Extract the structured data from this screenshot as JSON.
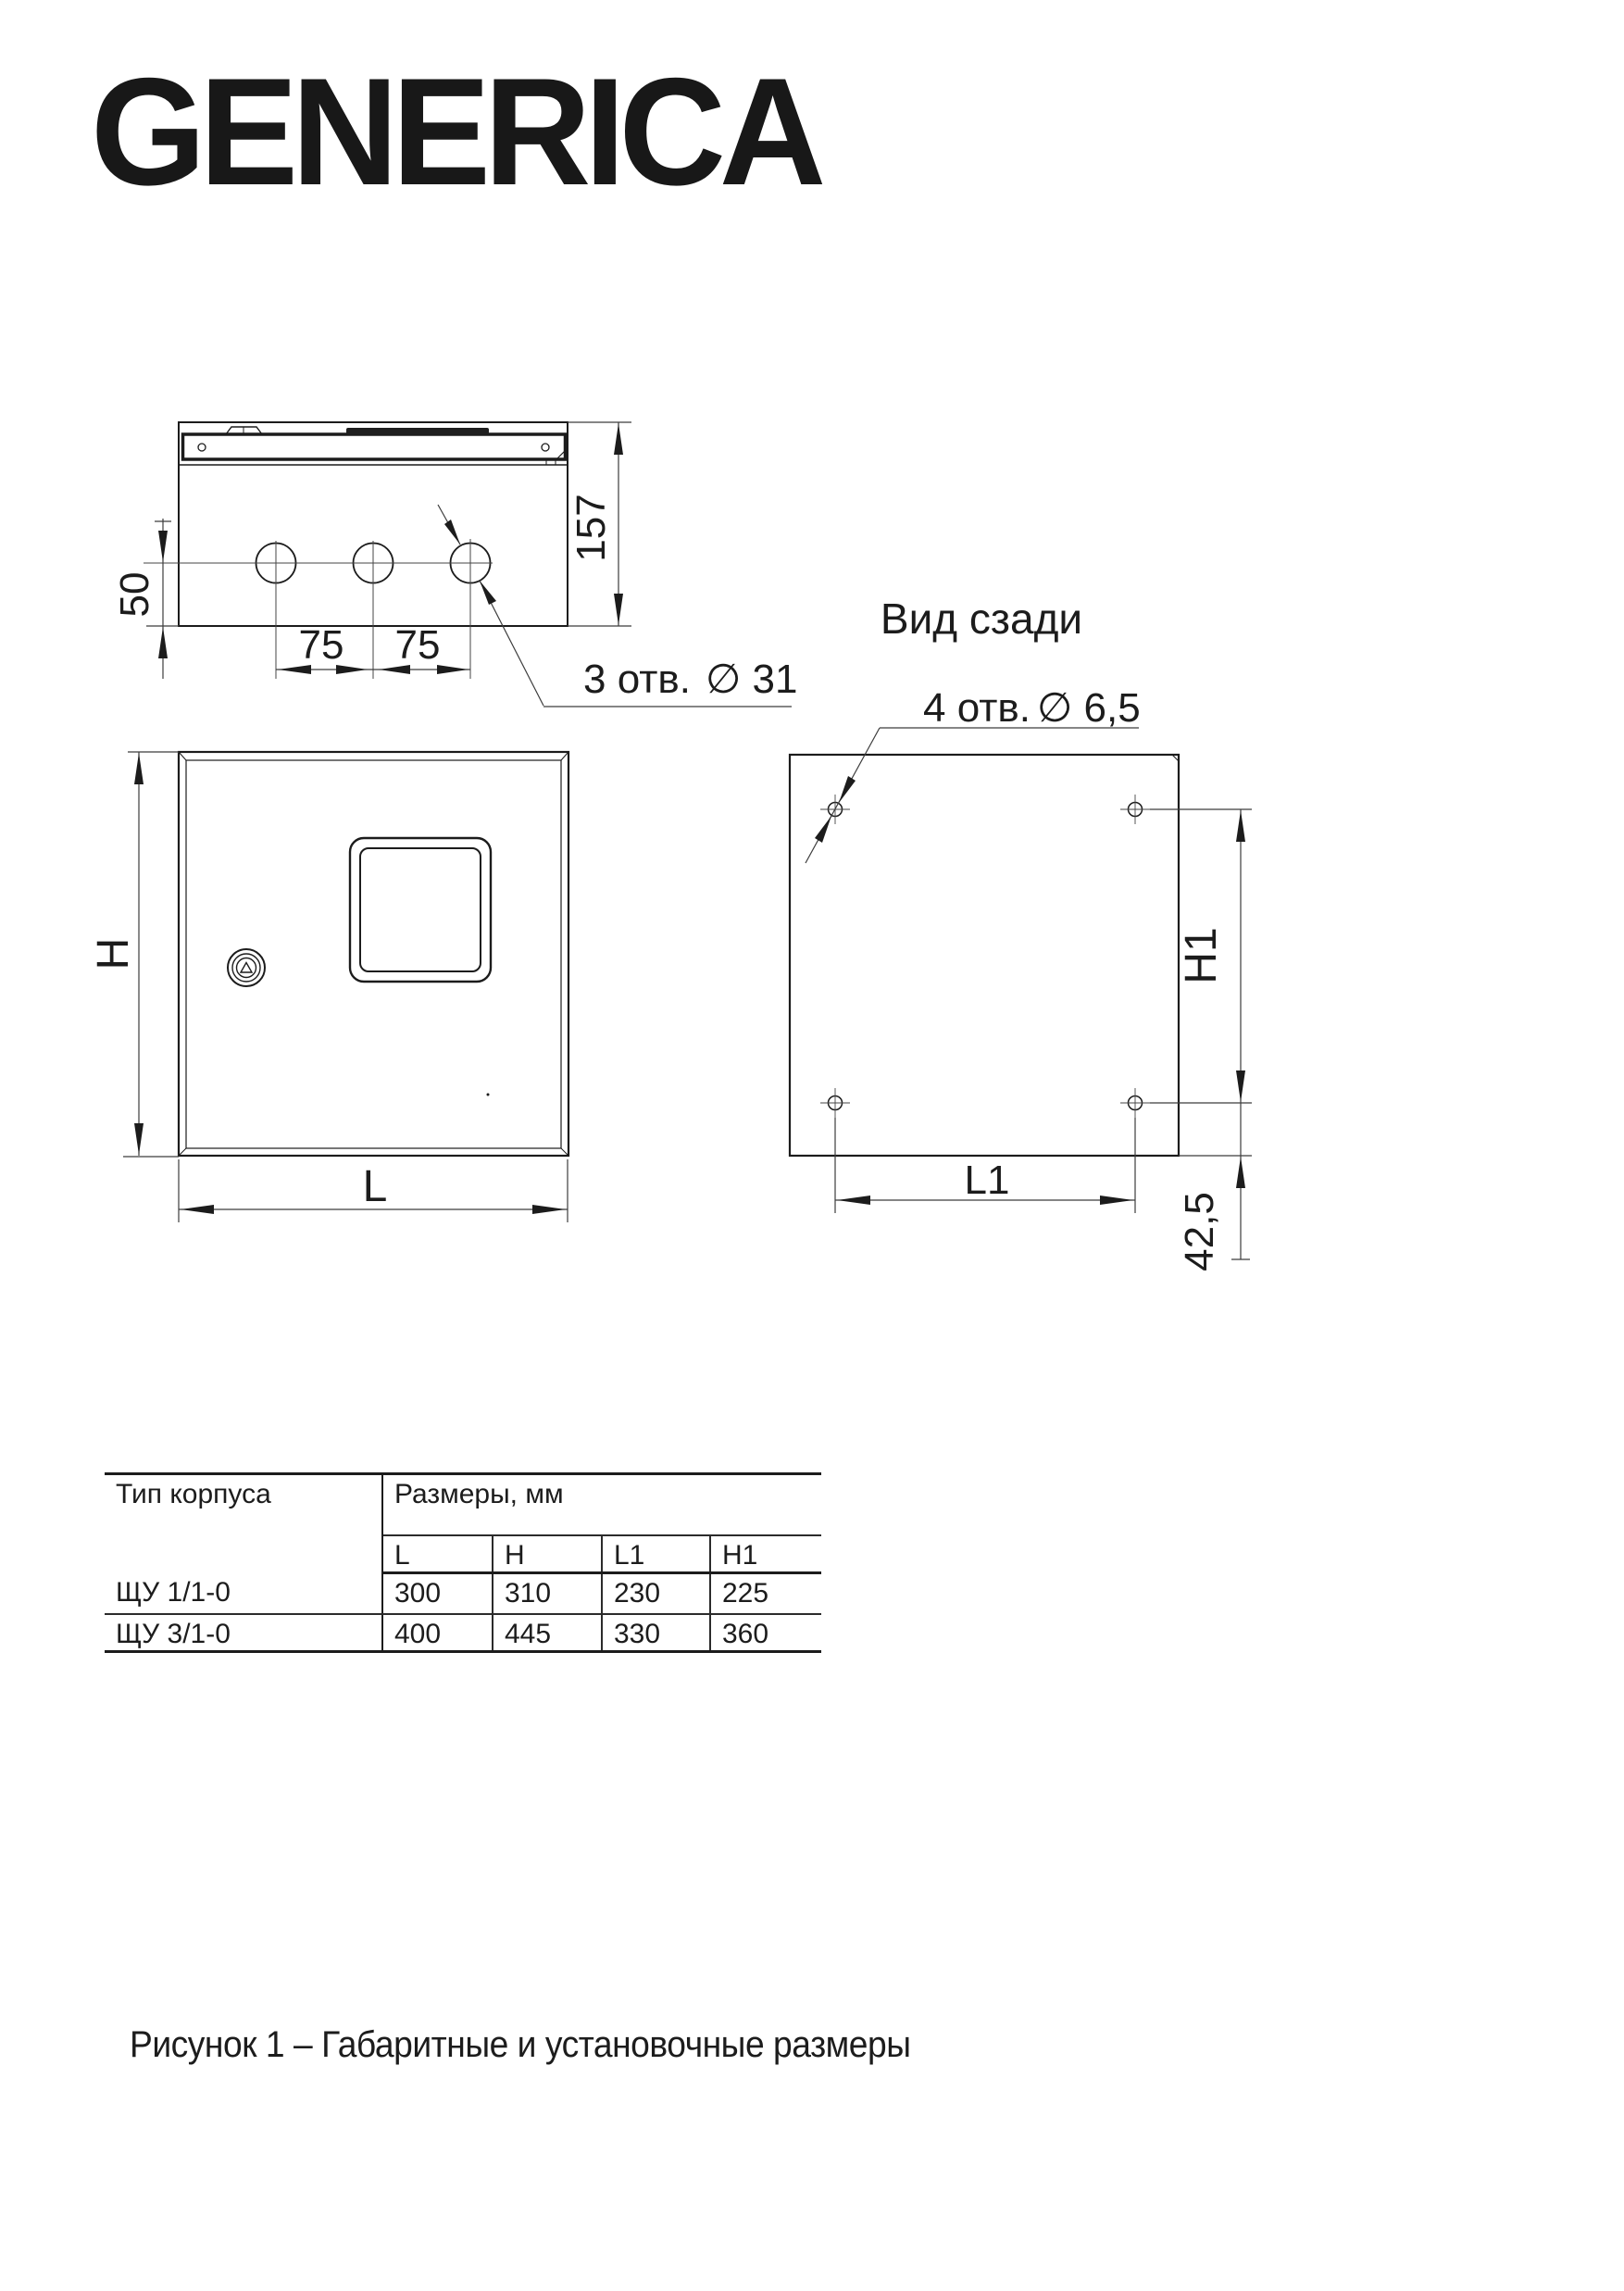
{
  "logo": {
    "text": "GENERICA"
  },
  "top_view": {
    "dim_depth": "157",
    "dim_hole_to_edge": "50",
    "dim_pitch_a": "75",
    "dim_pitch_b": "75",
    "holes_note": "3 отв.",
    "holes_dia": "∅ 31"
  },
  "front_view": {
    "dim_height": "H",
    "dim_width": "L"
  },
  "rear_view": {
    "title": "Вид сзади",
    "holes_note": "4 отв.",
    "holes_dia": "∅ 6,5",
    "dim_height": "H1",
    "dim_width": "L1",
    "dim_bottom": "42,5"
  },
  "table": {
    "col_type": "Тип корпуса",
    "col_sizes": "Размеры, мм",
    "size_headers": [
      "L",
      "H",
      "L1",
      "H1"
    ],
    "rows": [
      {
        "type": "ЩУ 1/1-0",
        "values": [
          "300",
          "310",
          "230",
          "225"
        ]
      },
      {
        "type": "ЩУ 3/1-0",
        "values": [
          "400",
          "445",
          "330",
          "360"
        ]
      }
    ]
  },
  "caption": "Рисунок 1 – Габаритные и установочные размеры"
}
